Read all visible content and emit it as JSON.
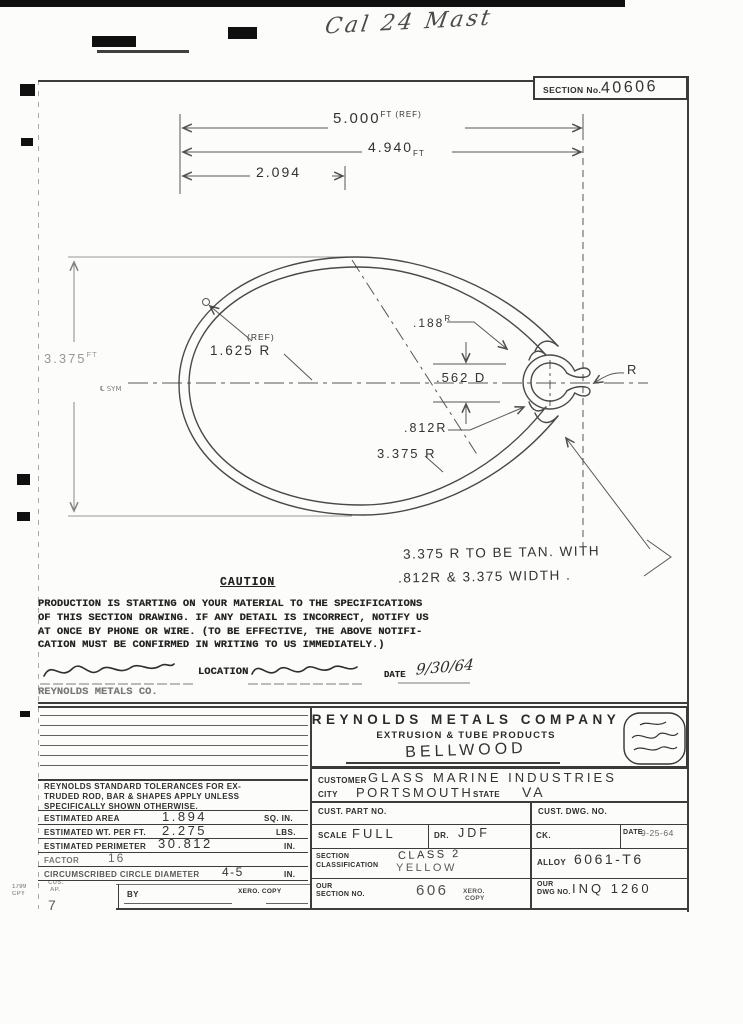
{
  "scan": {
    "title": "Cal 24 Mast",
    "margin": {
      "m1": "1799",
      "m2": "CPY",
      "m3": "CUS.",
      "m4": "AP.",
      "m5": "7"
    }
  },
  "header": {
    "section_label": "SECTION No.",
    "section_value": "40606"
  },
  "drawing": {
    "dim1_value": "5.000",
    "dim1_unit": "FT (REF)",
    "dim2_value": "4.940",
    "dim2_unit": "FT",
    "dim3_value": "2.094",
    "dimh_value": "3.375",
    "dimh_unit": "FT",
    "cl_sym": "℄ SYM",
    "ref_note": "(REF)",
    "r_main": "1.625 R",
    "r_lip": ".188",
    "r_lip_unit": "R",
    "d_bore": ".562 D",
    "r_groove": ".812R",
    "r_big": "3.375 R",
    "r_letter": "R",
    "note1": "3.375 R  TO  BE  TAN.  WITH",
    "note2": ".812R  &  3.375  WIDTH ."
  },
  "caution": {
    "heading": "CAUTION",
    "line1": "PRODUCTION IS STARTING ON YOUR MATERIAL TO THE SPECIFICATIONS",
    "line2": "OF THIS SECTION DRAWING.  IF ANY DETAIL IS INCORRECT, NOTIFY US",
    "line3": "AT ONCE BY PHONE OR WIRE.  (TO BE EFFECTIVE, THE ABOVE NOTIFI-",
    "line4": "CATION MUST BE CONFIRMED IN WRITING TO US IMMEDIATELY.)"
  },
  "approval": {
    "location_label": "LOCATION",
    "date_label": "DATE",
    "date_value": "9/30/64",
    "company": "REYNOLDS METALS CO."
  },
  "block": {
    "company": "REYNOLDS METALS COMPANY",
    "division": "EXTRUSION & TUBE PRODUCTS",
    "plant": "BELLWOOD",
    "customer_label": "CUSTOMER",
    "customer": "GLASS  MARINE  INDUSTRIES",
    "city_label": "CITY",
    "city": "PORTSMOUTH",
    "state_label": "STATE",
    "state": "VA",
    "cust_part_label": "CUST. PART NO.",
    "cust_dwg_label": "CUST. DWG. NO.",
    "scale_label": "SCALE",
    "scale": "FULL",
    "dr_label": "DR.",
    "dr": "JDF",
    "ck_label": "CK.",
    "date_label": "DATE",
    "date": "9-25-64",
    "class_label1": "SECTION",
    "class_label2": "CLASSIFICATION",
    "class_value": "CLASS 2",
    "class_color": "YELLOW",
    "alloy_label": "ALLOY",
    "alloy": "6061-T6",
    "oursec_label1": "OUR",
    "oursec_label2": "SECTION NO.",
    "oursec": "606",
    "xero1": "XERO.",
    "xero2": "COPY",
    "ourdwg_label1": "OUR",
    "ourdwg_label2": "DWG NO.",
    "ourdwg": "INQ 1260"
  },
  "tol": {
    "line1": "REYNOLDS STANDARD TOLERANCES FOR EX-",
    "line2": "TRUDED ROD, BAR & SHAPES APPLY UNLESS",
    "line3": "SPECIFICALLY SHOWN OTHERWISE.",
    "area_label": "ESTIMATED AREA",
    "area": "1.894",
    "area_unit": "SQ. IN.",
    "wt_label": "ESTIMATED WT. PER FT.",
    "wt": "2.275",
    "wt_unit": "LBS.",
    "per_label": "ESTIMATED PERIMETER",
    "per": "30.812",
    "per_unit": "IN.",
    "factor_label": "FACTOR",
    "factor": "16",
    "circle_label": "CIRCUMSCRIBED CIRCLE DIAMETER",
    "circle": "4-5",
    "circle_unit": "IN."
  },
  "footer": {
    "by_label": "BY",
    "xero_label": "XERO. COPY"
  }
}
